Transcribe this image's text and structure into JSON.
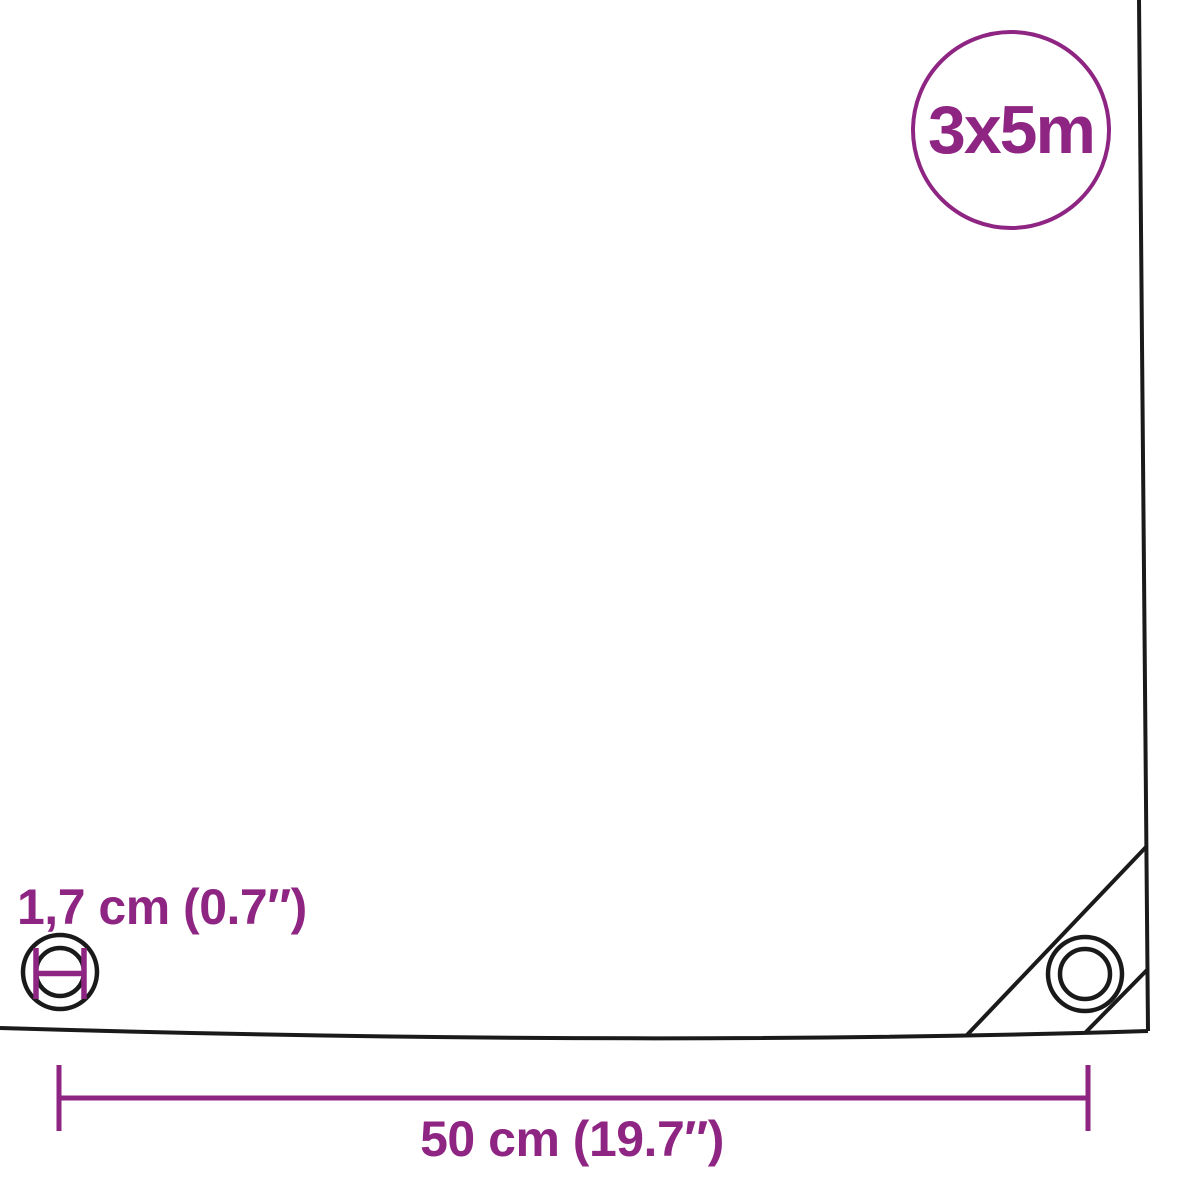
{
  "diagram": {
    "size_badge": {
      "label": "3x5m"
    },
    "eyelet": {
      "diameter_label": "1,7 cm (0.7″)"
    },
    "spacing": {
      "label": "50 cm (19.7″)"
    }
  },
  "colors": {
    "accent": "#8E2583",
    "line": "#1A1A1A",
    "background": "#FFFFFF"
  },
  "icons": {
    "eyelet_diameter_icon": "double-circle-with-measure-bars",
    "corner_grommet_icon": "double-circle-grommet",
    "size_badge_circle": "circle-outline"
  }
}
